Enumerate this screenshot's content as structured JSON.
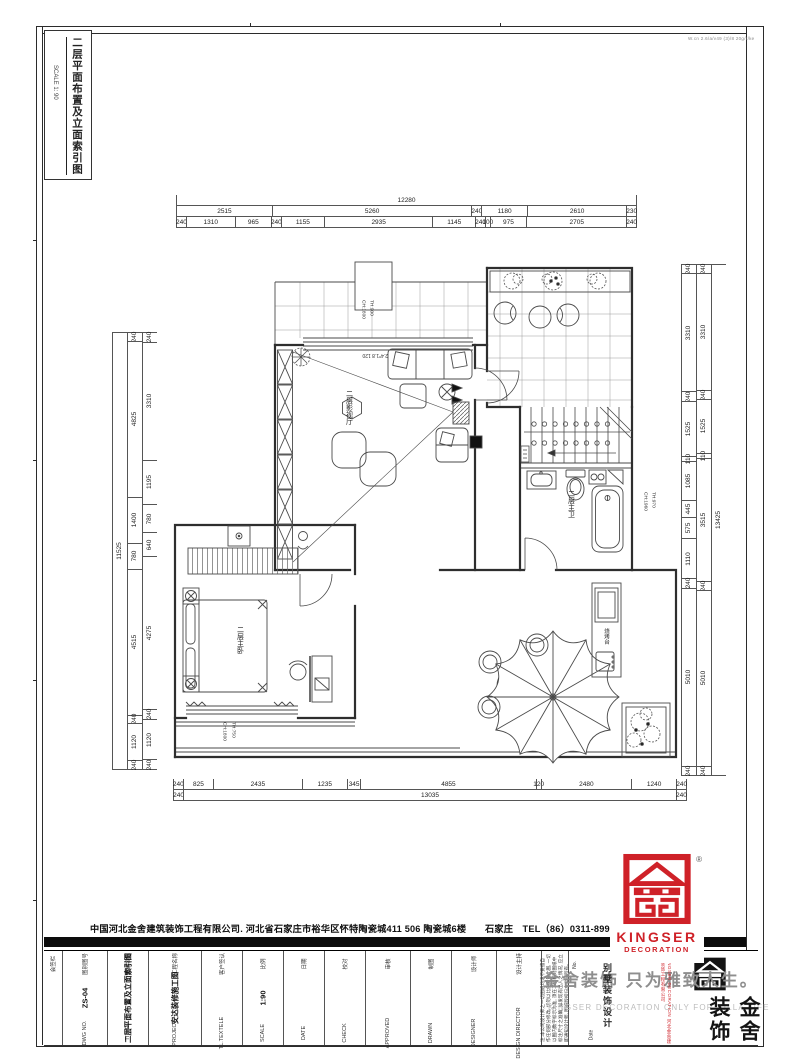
{
  "sheet": {
    "side_tab": {
      "title": "二层平面布置及立面索引图",
      "scale": "SCALE 1: 90"
    },
    "top_note": "W.cn 2.6/a/v49 (3)/8 20g/r/ke",
    "company_line": "中国河北金舍建筑装饰工程有限公司. 河北省石家庄市裕华区怀特陶瓷城411 506 陶瓷城6楼　　石家庄　TEL（86）0311-89925555"
  },
  "plan": {
    "labels": {
      "media_room": "二层影视厅",
      "bathroom": "二层主卫",
      "bedroom": "二层主卧",
      "bbq_counter": "烧烤台",
      "balcony_note1": "CH:1800",
      "balcony_note2": "TH:900",
      "bath_note1": "CH:1960",
      "bath_note2": "TH:970",
      "bedroom_note1": "CH:1800",
      "bedroom_note2": "TH:750",
      "window_note": "2.4*1.8 120"
    },
    "dims": {
      "top_total": [
        "12280"
      ],
      "top_row2": [
        "2515",
        "5260",
        "240",
        "1180",
        "2610",
        "230"
      ],
      "top_row3": [
        "240",
        "1310",
        "965",
        "240",
        "1155",
        "2935",
        "1145",
        "240",
        "100",
        "975",
        "2705",
        "240"
      ],
      "bottom_row1": [
        "240",
        "825",
        "2435",
        "1235",
        "345",
        "4855",
        "120",
        "2480",
        "1240",
        "240"
      ],
      "bottom_row2": [
        "240",
        "13035",
        "240"
      ],
      "left_total": [
        "11525"
      ],
      "left_mid": [
        "240",
        "4825",
        "1400",
        "780",
        "4515",
        "240",
        "1120",
        "240"
      ],
      "left_inner": [
        "240",
        "3310",
        "1195",
        "780",
        "640",
        "4275",
        "240",
        "1120",
        "240"
      ],
      "right_inner": [
        "240",
        "3310",
        "240",
        "1525",
        "110",
        "1085",
        "445",
        "575",
        "1110",
        "240",
        "5010",
        "240"
      ],
      "right_mid": [
        "240",
        "3310",
        "240",
        "1525",
        "110",
        "3515",
        "240",
        "5010",
        "240"
      ],
      "right_total": [
        "13425"
      ]
    }
  },
  "titleblock": {
    "columns": [
      {
        "header": "会签栏",
        "sub": "",
        "value": "",
        "w": "18"
      },
      {
        "header": "图别图号",
        "sub": "DWG NO.",
        "value": "ZS-04",
        "w": "44"
      },
      {
        "header": "图纸名称",
        "sub": "TITLE",
        "value": "二层平面布置及立面索引图",
        "w": "40"
      },
      {
        "header": "工程名称",
        "sub": "PROJECT",
        "value": "安达装修施工图",
        "w": "52"
      },
      {
        "header": "客户签认",
        "sub": "TL.TEXTELE",
        "value": "",
        "w": "40"
      },
      {
        "header": "比例",
        "sub": "SCALE",
        "value": "1:90",
        "w": "40"
      },
      {
        "header": "日期",
        "sub": "DATE",
        "value": "",
        "w": "40"
      },
      {
        "header": "校对",
        "sub": "CHECK",
        "value": "",
        "w": "40"
      },
      {
        "header": "审核",
        "sub": "APPROVED",
        "value": "",
        "w": "44"
      },
      {
        "header": "制图",
        "sub": "DRAWN",
        "value": "",
        "w": "40"
      },
      {
        "header": "设计师",
        "sub": "DESIGNER",
        "value": "",
        "w": "44"
      },
      {
        "header": "设计主持",
        "sub": "DESIGN DIRECTOR",
        "value": "",
        "w": "44"
      }
    ],
    "notes": "注:本公司设计师之一切图纸均请不要擅自作任何部分修改, 切勿以比例测量此图, 一切以图内数字标示为准, 须在工地核对图纸中标注尺寸之准确, 如发现有出入之情况, 应立即通知设计师, 图纸版权归本公司所有。",
    "watermark_cn": "金舍装饰 只为雅致人生。",
    "watermark_en": "KINGSER DECORATION  ONLY FOR VILLA LIFE",
    "side_text": "别墅装饰设计",
    "brand_vertical": "KINGSER DECORATION 河北金舍建筑装饰工程有限公司",
    "logo_chars": "金舍装饰",
    "no_label": "No.",
    "date_label": "Date"
  },
  "logo": {
    "brand": "KINGSER",
    "sub": "DECORATION",
    "reg": "®"
  }
}
